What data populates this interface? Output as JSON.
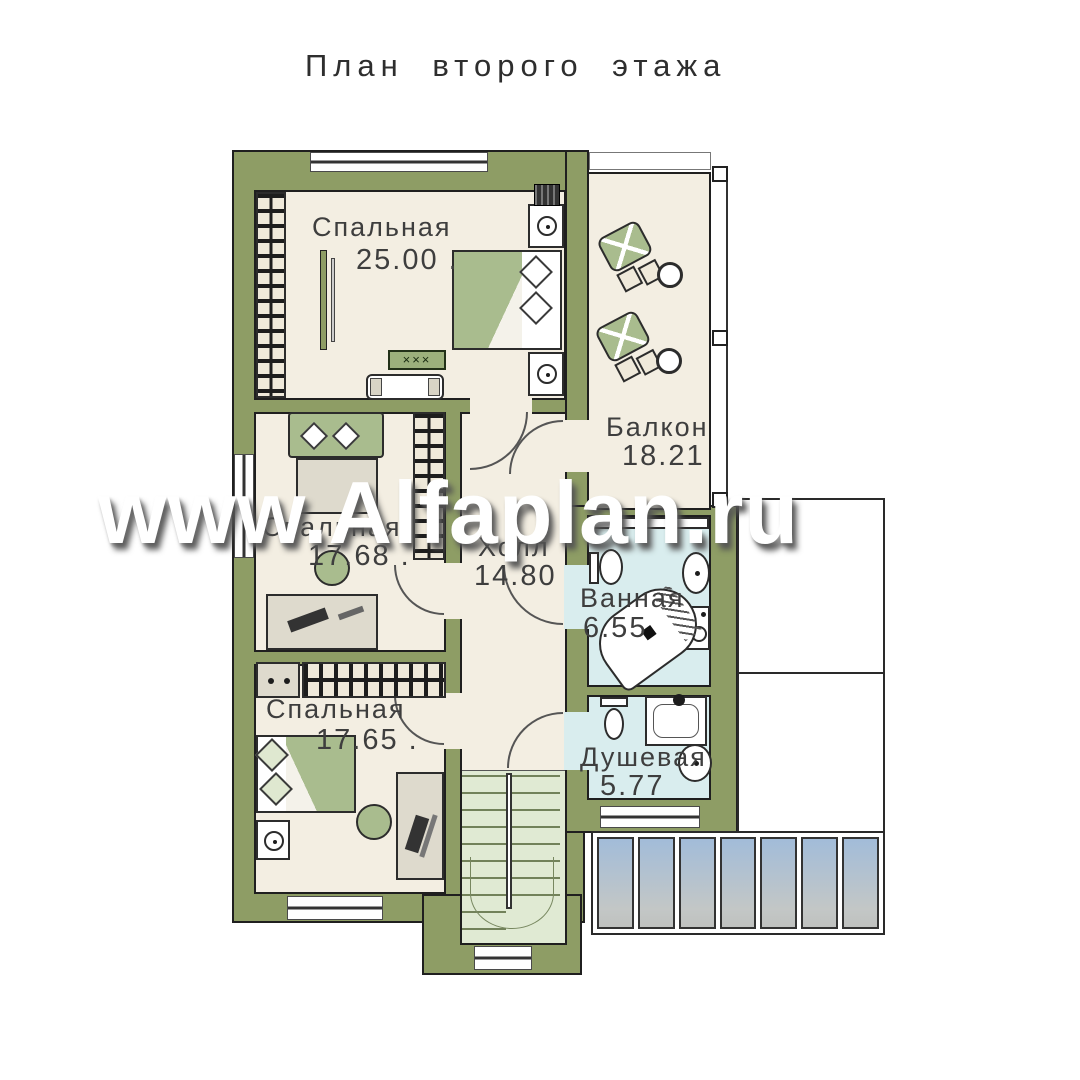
{
  "title": "План второго этажа",
  "watermark": "www.Alfaplan.ru",
  "rooms": [
    {
      "name": "Спальная",
      "area": "25.00 ."
    },
    {
      "name": "Спальная",
      "area": "17.68 ."
    },
    {
      "name": "Спальная",
      "area": "17.65 ."
    },
    {
      "name": "Холл",
      "area": "14.80"
    },
    {
      "name": "Балкон",
      "area": "18.21"
    },
    {
      "name": "Ванная",
      "area": "6.55"
    },
    {
      "name": "Душевая",
      "area": "5.77"
    }
  ],
  "labels": {
    "coffee_table": "×××"
  },
  "colors": {
    "wall": "#8e9d65",
    "floor": "#f3eee2",
    "wet_floor": "#d9edee",
    "stairs": "#e0ead3",
    "furniture": "#a9bc8e",
    "outline": "#1f1f1f",
    "skylight_top": "#a2bcd9",
    "skylight_bottom": "#c3c7c6"
  }
}
